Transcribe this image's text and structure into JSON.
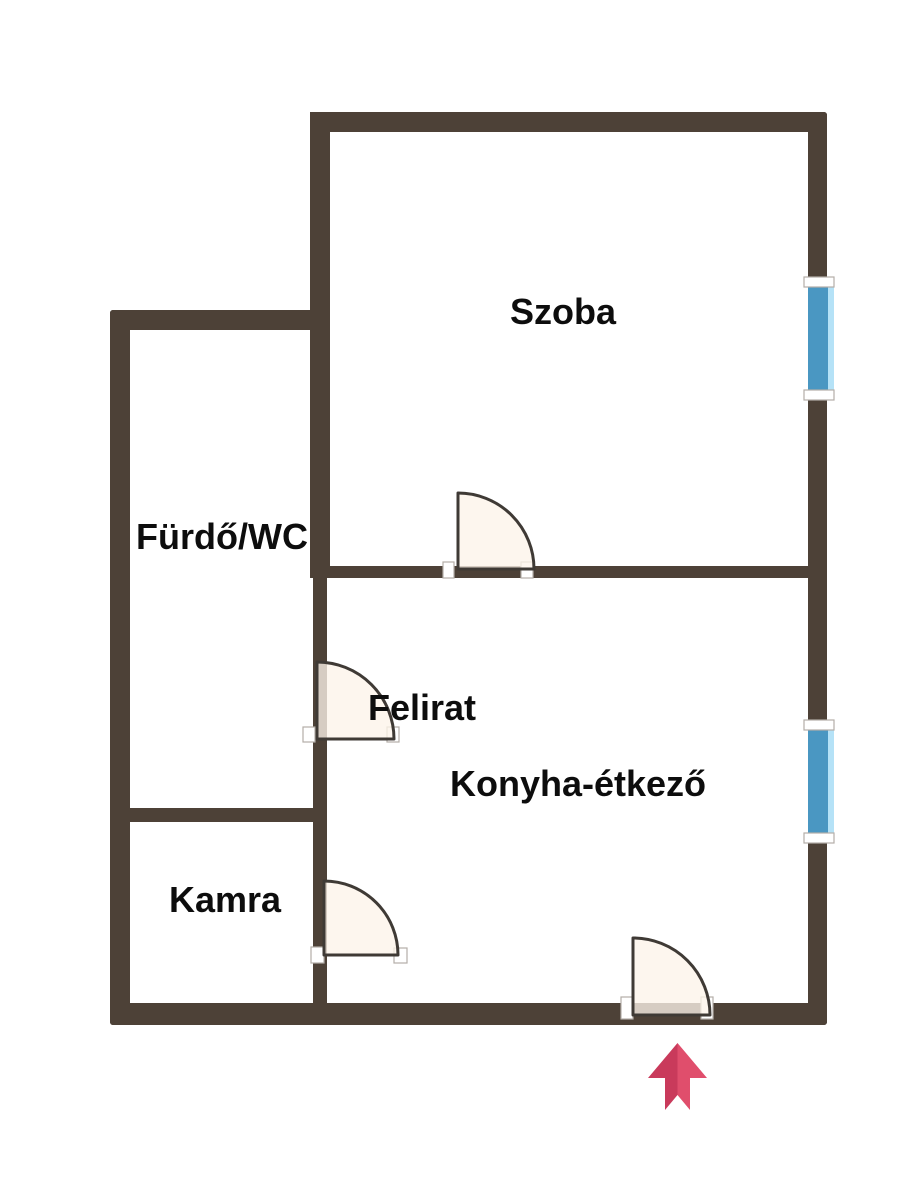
{
  "floorplan": {
    "labels": {
      "szoba": "Szoba",
      "furdo_wc": "Fürdő/WC",
      "felirat": "Felirat",
      "konyha_etkezo": "Konyha-étkező",
      "kamra": "Kamra"
    },
    "colors": {
      "wall": "#4d4137",
      "window_blue": "#4a97c2",
      "window_light_blue": "#b5e2f7",
      "door_fill": "#fdf3e9",
      "door_outline": "#3f3a35",
      "frame_cap": "#ffffff",
      "arrow_dark": "#c93a5b",
      "arrow_light": "#e04e6c",
      "label_text": "#0d0d0d",
      "background": "#ffffff"
    },
    "symbols": {
      "doors": [
        "szoba-door",
        "felirat-door",
        "kamra-door",
        "entrance-door"
      ],
      "windows": [
        "szoba-window",
        "konyha-window"
      ],
      "entrance_arrow": "arrow-up"
    }
  }
}
